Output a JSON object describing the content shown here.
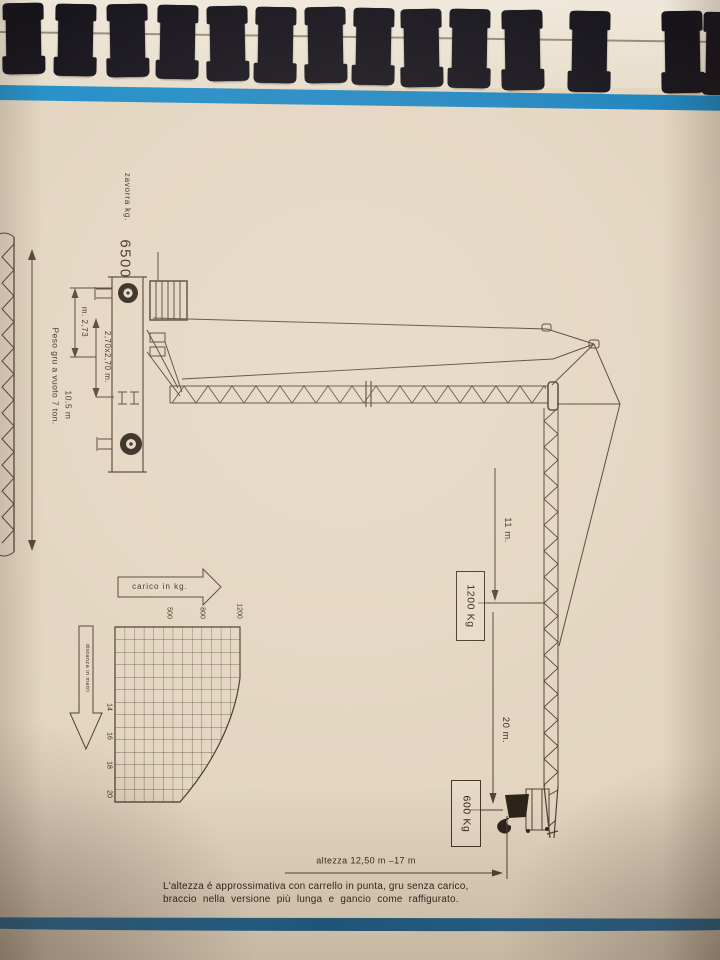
{
  "document": {
    "type": "pagina di catalogo tecnico gru (scansione, disegno ruotato)",
    "binding": "spiral-binding"
  },
  "drawing": {
    "zavorra_label": "zavorra kg.",
    "zavorra_value": "6500",
    "track_width": "m. 2,73",
    "base_size": "2,70x2,70 m.",
    "empty_weight": "Peso gru a vuoto 7 ton.",
    "transport_height": "10.5 m",
    "radius_1": "11 m.",
    "load_1": "1200 Kg",
    "radius_2": "20 m.",
    "load_2": "600 Kg",
    "height_range": "altezza  12,50 m –17 m"
  },
  "chart": {
    "load_axis": "carico in kg.",
    "distance_axis": "distanza in metri",
    "load_ticks": [
      "500",
      "800",
      "1200"
    ],
    "distance_ticks": [
      "14",
      "16",
      "18",
      "20"
    ]
  },
  "chart_data": {
    "type": "line",
    "title": "Diagramma di carico (carico in kg. / distanza in metri)",
    "xlabel": "distanza in metri",
    "ylabel": "carico in kg.",
    "x_ticks": [
      14,
      16,
      18,
      20
    ],
    "y_ticks": [
      500,
      800,
      1200
    ],
    "xlim": [
      11,
      20
    ],
    "ylim": [
      500,
      1200
    ],
    "grid": true,
    "series": [
      {
        "name": "carico massimo al carrello",
        "points_distanza_m_carico_kg": [
          [
            11,
            1200
          ],
          [
            14,
            1080
          ],
          [
            16,
            970
          ],
          [
            18,
            780
          ],
          [
            20,
            600
          ]
        ]
      }
    ]
  },
  "footnote": {
    "line1": "L'altezza é approssimativa con carrello in punta, gru senza carico,",
    "line2": "braccio nella versione più lunga e gancio come raffigurato."
  },
  "colors": {
    "stripe_top": "#1e86c1",
    "stripe_bottom": "#276a99",
    "paper": "#e5d7c2",
    "ink": "#453627",
    "binding": "#17141c"
  }
}
